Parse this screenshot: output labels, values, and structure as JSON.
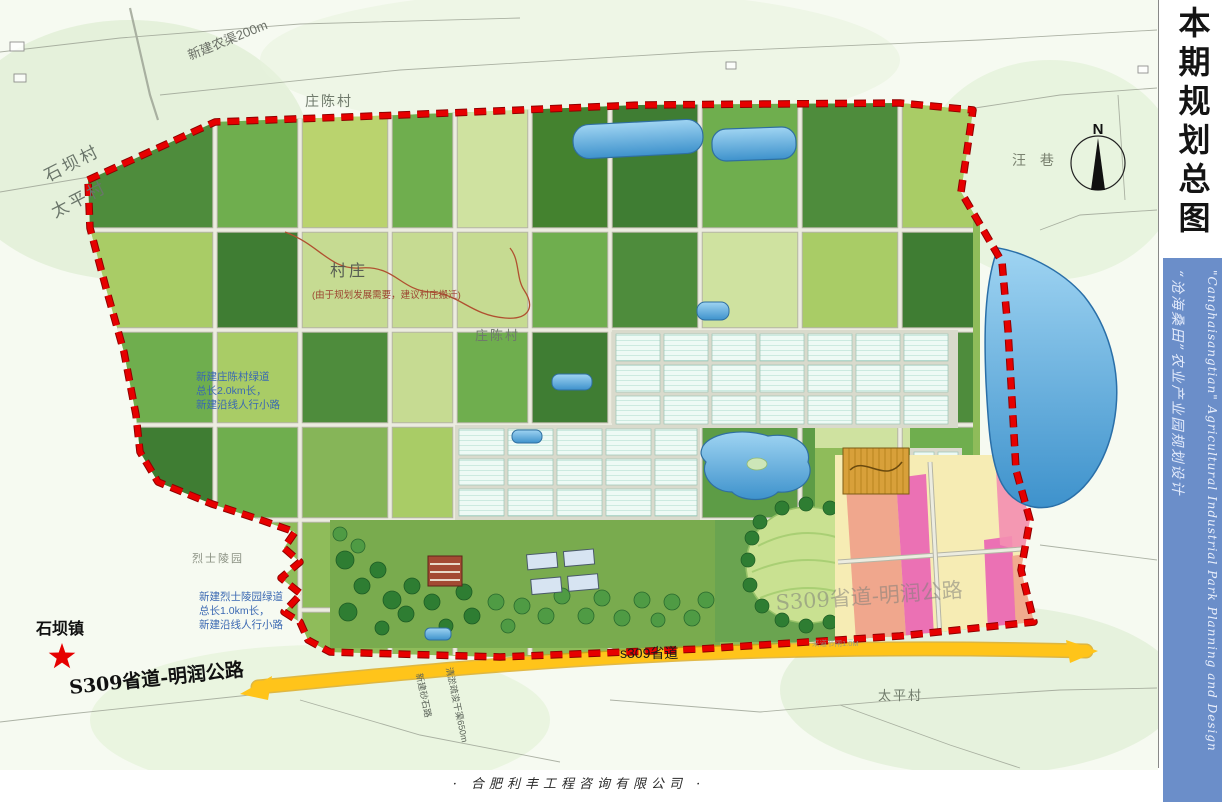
{
  "sidebar": {
    "title": "本期规划总图",
    "strip_cn": "“沧海桑田”农业产业园规划设计",
    "strip_en": "\"Canghaisangtian\" Agricultural Industrial Park Planning and Design"
  },
  "footer": {
    "company": "· 合肥利丰工程咨询有限公司 ·"
  },
  "map": {
    "labels": {
      "canal_top": "新建农渠200m",
      "village_zhuangchen_top": "庄陈村",
      "village_shibacun": "石坝村",
      "village_taiping_left": "太平村",
      "village_note_title": "村庄",
      "village_note_body": "(由于规划发展需要，建议村庄搬迁)",
      "village_zhuangchen_mid": "庄陈村",
      "greenway_mid_1": "新建庄陈村绿道",
      "greenway_mid_2": "总长2.0km长，",
      "greenway_mid_3": "新建沿线人行小路",
      "martyr_park": "烈士陵园",
      "greenway_martyr_1": "新建烈士陵园绿道",
      "greenway_martyr_2": "总长1.0km长，",
      "greenway_martyr_3": "新建沿线人行小路",
      "town_shiba": "石坝镇",
      "road_s309_full": "S309省道-明润公路",
      "road_s309_on": "s309省道",
      "road_s309_faded": "S309省道-明润公路",
      "gate_note": "来道节闸1.0M",
      "village_wangxiang": "汪 巷",
      "village_taiping_right": "太平村",
      "compass_n": "N",
      "new_gravel_road": "新建砂石路",
      "dredge_canal": "清淤疏浚干渠650m"
    },
    "colors": {
      "boundary_red": "#d10000",
      "road_yellow": "#ffc41a",
      "water_blue": "#3e92cc",
      "strip_blue": "#6b8ec9",
      "field_dark": "#3f7d33",
      "field_mid": "#6fae4e",
      "field_light": "#a9cc66",
      "field_pale": "#cfe2a0",
      "greenhouse": "#eefaf5",
      "zone_magenta": "#ea64b4",
      "zone_salmon": "#f0a088",
      "zone_sand": "#f6ecb4",
      "orchard_gold": "#d8a03a",
      "star_red": "#e60000"
    }
  }
}
